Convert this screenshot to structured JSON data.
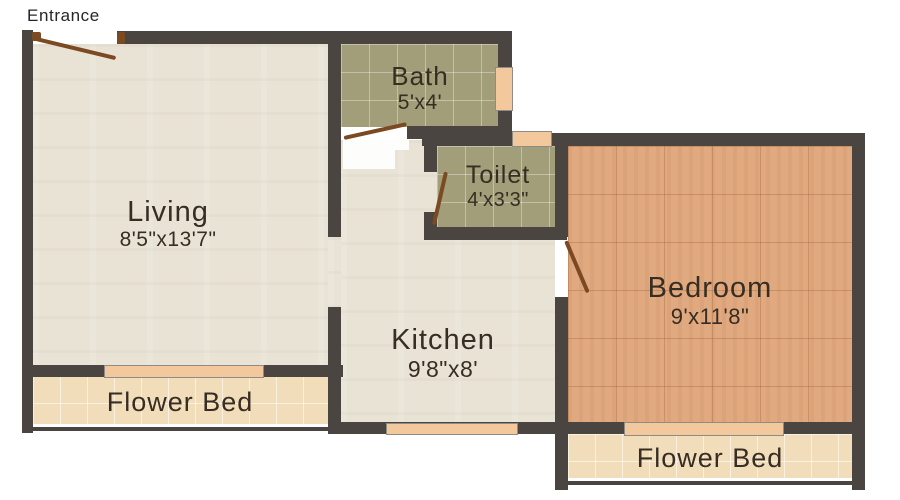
{
  "entrance": {
    "label": "Entrance"
  },
  "rooms": {
    "living": {
      "name": "Living",
      "dims": "8'5\"x13'7\""
    },
    "bath": {
      "name": "Bath",
      "dims": "5'x4'"
    },
    "toilet": {
      "name": "Toilet",
      "dims": "4'x3'3\""
    },
    "kitchen": {
      "name": "Kitchen",
      "dims": "9'8\"x8'"
    },
    "bedroom": {
      "name": "Bedroom",
      "dims": "9'x11'8\""
    },
    "flower_bed_left": {
      "name": "Flower Bed"
    },
    "flower_bed_right": {
      "name": "Flower Bed"
    }
  },
  "features": {
    "windows": [
      "bath-right-window",
      "toilet-top-window",
      "living-flowerbed-window",
      "kitchen-bottom-window",
      "bedroom-flowerbed-window"
    ],
    "doors": [
      "entrance-door",
      "bath-door",
      "toilet-door",
      "bedroom-door"
    ]
  },
  "colors": {
    "background": "#ffffff",
    "wall": "#4a4540",
    "floor_living": "#e9e3d6",
    "tile_bath": "#a29e7a",
    "tile_bedroom": "#e1a97f",
    "tile_flower_bed": "#f2ddbb",
    "window": "#f4c89d",
    "door": "#7b4a22",
    "text": "#372d22"
  }
}
